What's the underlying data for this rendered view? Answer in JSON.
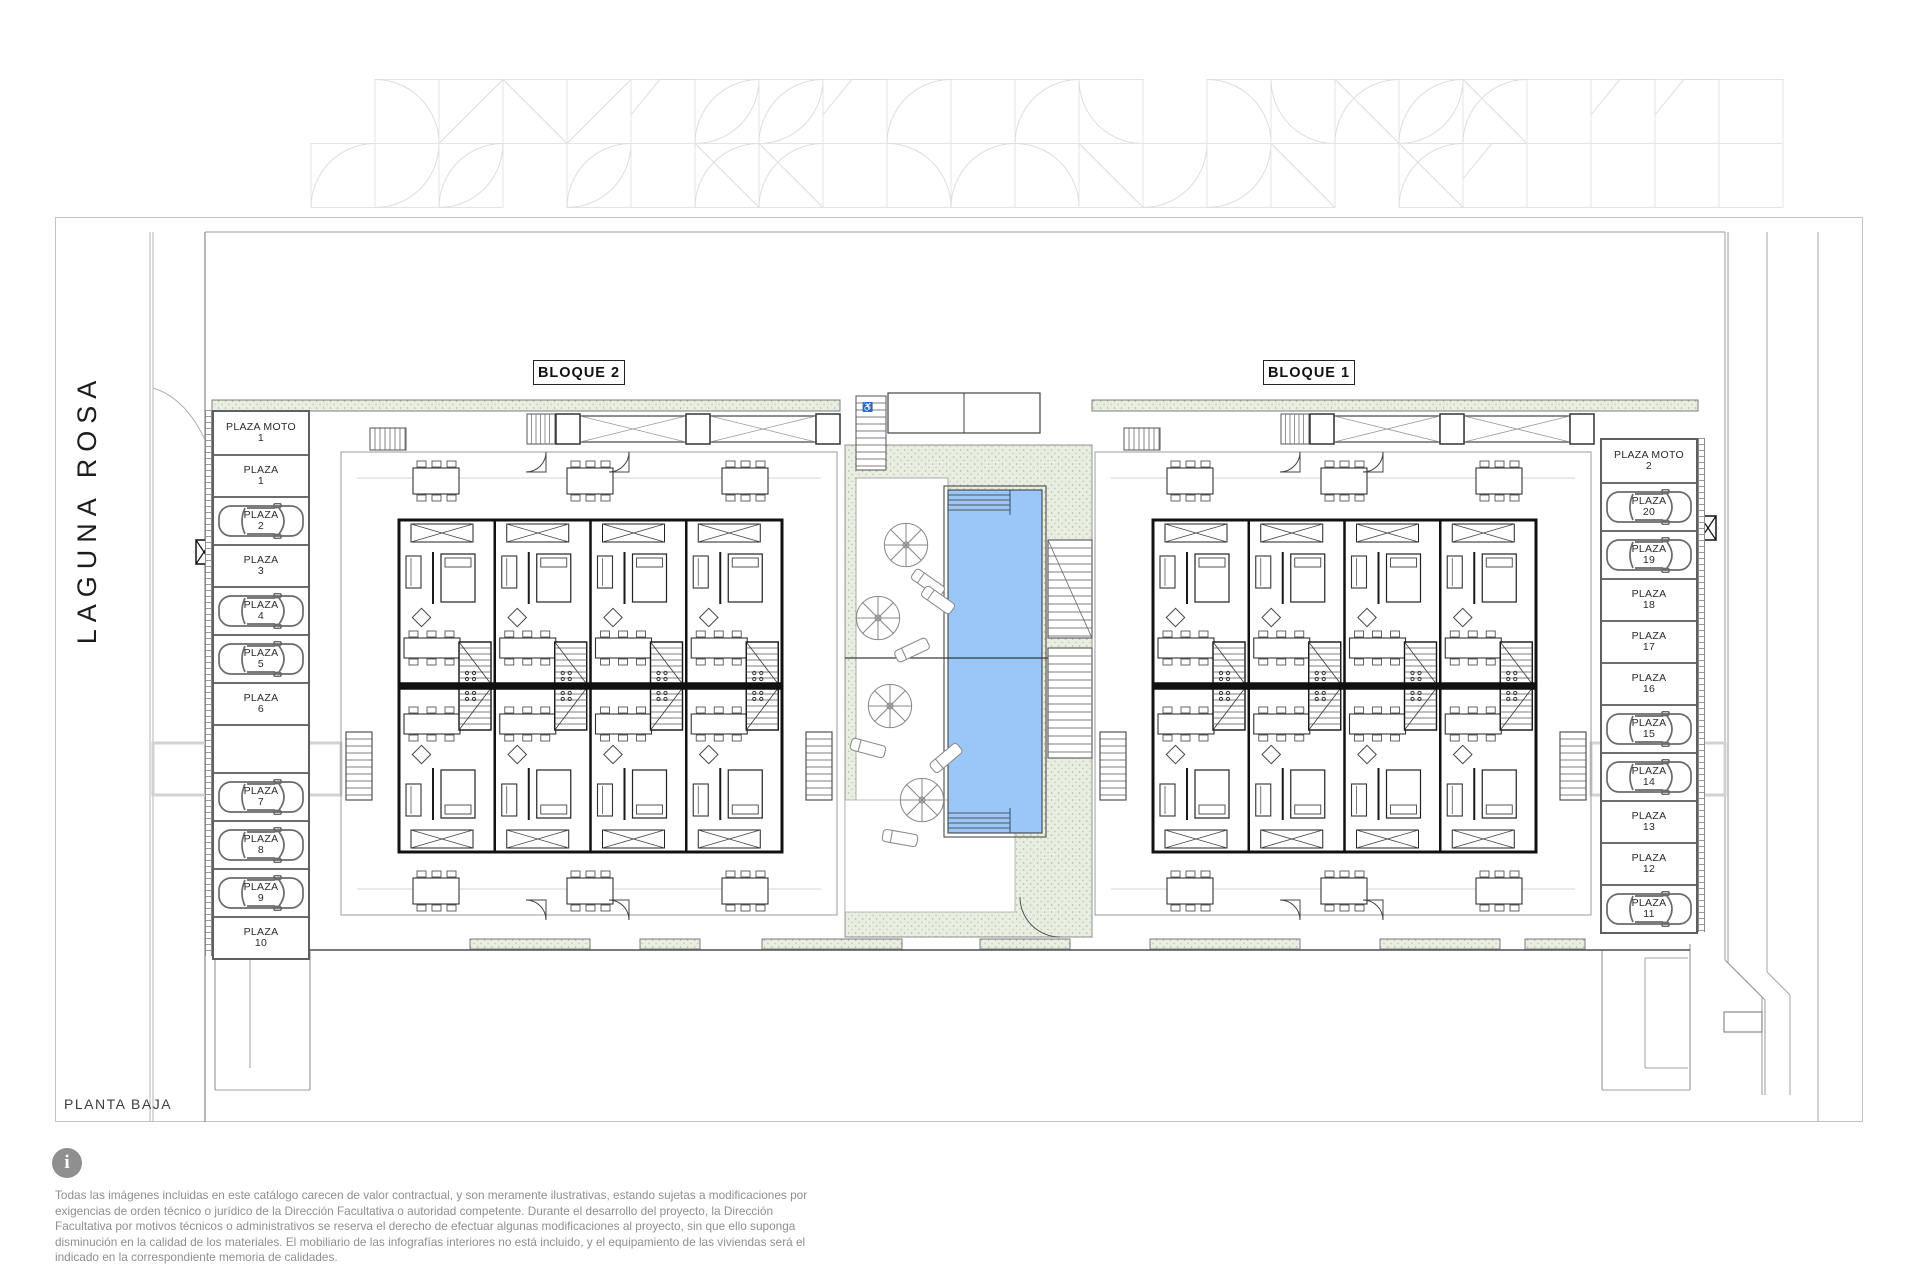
{
  "page": {
    "street_name": "LAGUNA ROSA",
    "plan_label": "PLANTA BAJA",
    "info_icon": "i"
  },
  "blocks": [
    {
      "label": "BLOQUE 2"
    },
    {
      "label": "BLOQUE 1"
    }
  ],
  "parking": {
    "left": {
      "slots": [
        {
          "name": "PLAZA MOTO",
          "number": "1",
          "car": false,
          "moto": true
        },
        {
          "name": "PLAZA",
          "number": "1",
          "car": false
        },
        {
          "name": "PLAZA",
          "number": "2",
          "car": true
        },
        {
          "name": "PLAZA",
          "number": "3",
          "car": false
        },
        {
          "name": "PLAZA",
          "number": "4",
          "car": true
        },
        {
          "name": "PLAZA",
          "number": "5",
          "car": true
        },
        {
          "name": "PLAZA",
          "number": "6",
          "car": false
        },
        {
          "name": "PLAZA",
          "number": "7",
          "car": true
        },
        {
          "name": "PLAZA",
          "number": "8",
          "car": true
        },
        {
          "name": "PLAZA",
          "number": "9",
          "car": true
        },
        {
          "name": "PLAZA",
          "number": "10",
          "car": false
        }
      ],
      "gap_after_index": 6
    },
    "right": {
      "slots": [
        {
          "name": "PLAZA MOTO",
          "number": "2",
          "car": false,
          "moto": true
        },
        {
          "name": "PLAZA",
          "number": "20",
          "car": true
        },
        {
          "name": "PLAZA",
          "number": "19",
          "car": true
        },
        {
          "name": "PLAZA",
          "number": "18",
          "car": false
        },
        {
          "name": "PLAZA",
          "number": "17",
          "car": false
        },
        {
          "name": "PLAZA",
          "number": "16",
          "car": false
        },
        {
          "name": "PLAZA",
          "number": "15",
          "car": true
        },
        {
          "name": "PLAZA",
          "number": "14",
          "car": true
        },
        {
          "name": "PLAZA",
          "number": "13",
          "car": false
        },
        {
          "name": "PLAZA",
          "number": "12",
          "car": false
        },
        {
          "name": "PLAZA",
          "number": "11",
          "car": true
        }
      ],
      "gap_after_index": -1
    }
  },
  "courtyard": {
    "pool_color": "#9bc7f8",
    "deck_color": "#e9eee2",
    "deck_dot_color": "#a9bd97"
  },
  "disclaimer": "Todas las imágenes incluidas en este catálogo carecen de valor contractual, y son meramente ilustrativas, estando sujetas a modificaciones por exigencias de  orden técnico o jurídico de la Dirección Facultativa o autoridad competente. Durante el desarrollo del proyecto, la Dirección Facultativa por motivos técnicos o administrativos se reserva el derecho de efectuar algunas modificaciones al proyecto, sin que ello suponga disminución  en la calidad de los materiales. El mobiliario de las infografías interiores no está incluido, y el equipamiento de las viviendas será el indicado en la correspondiente memoria de calidades."
}
